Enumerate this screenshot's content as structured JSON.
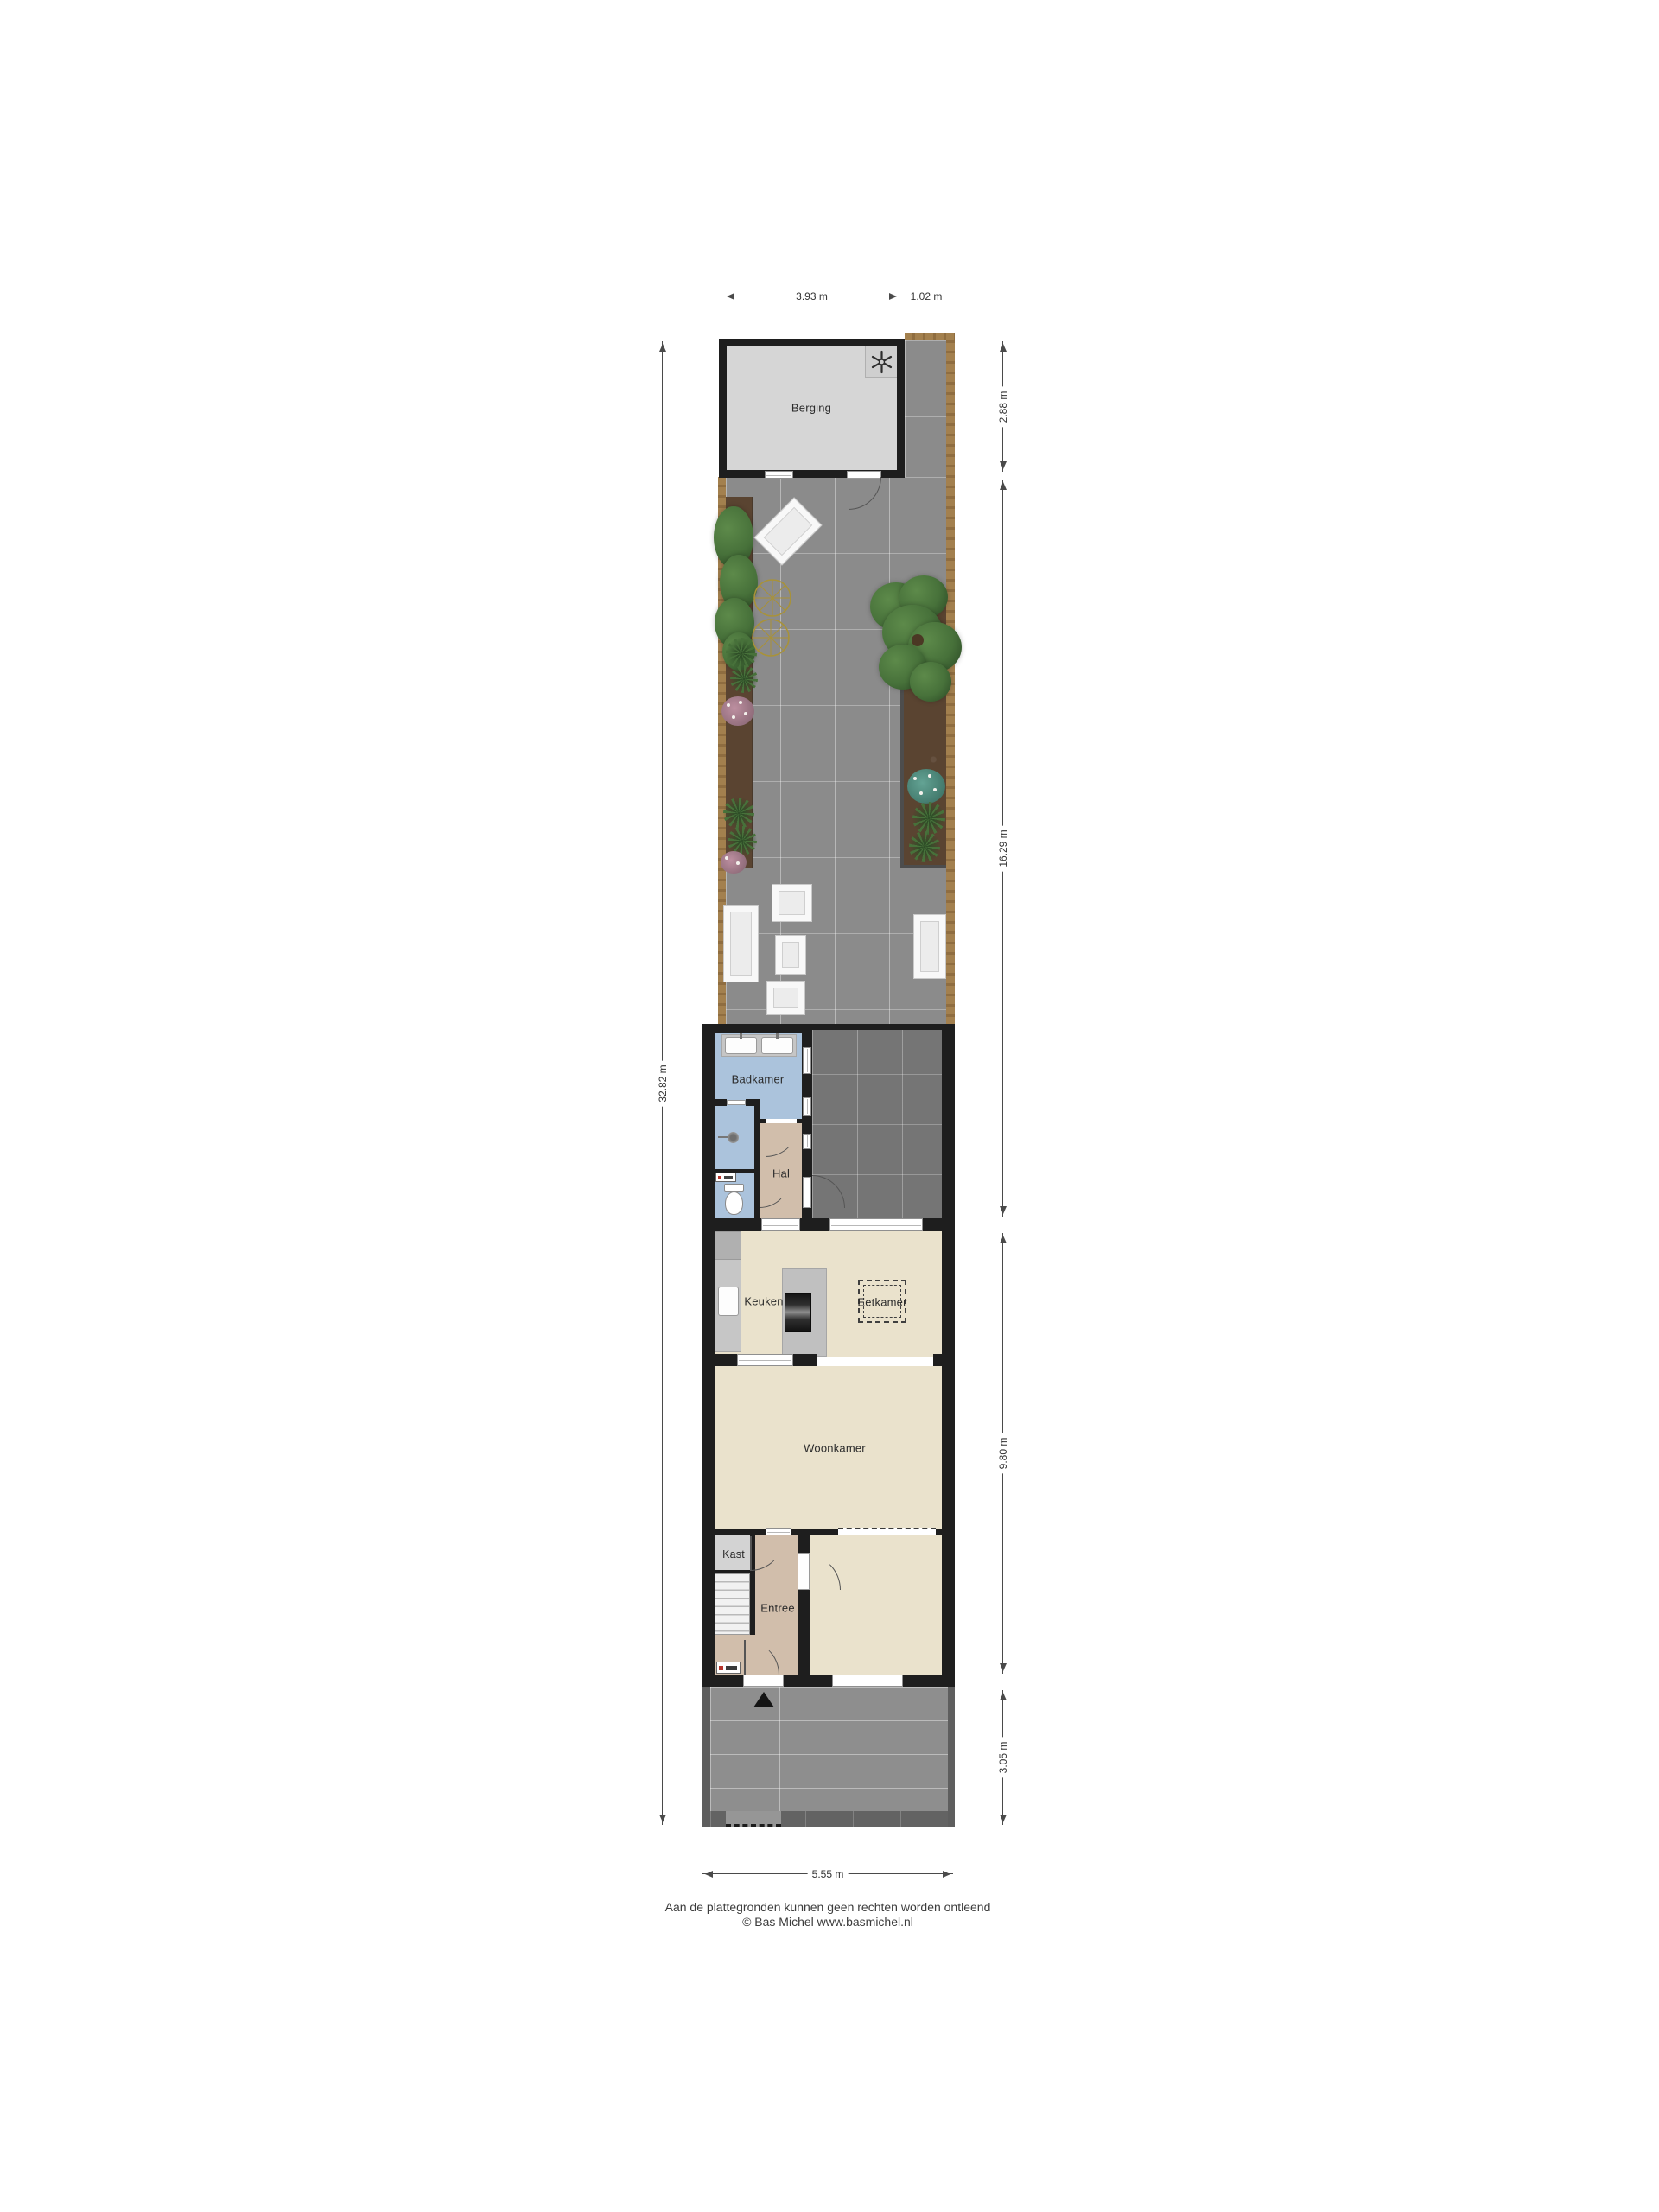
{
  "rooms": {
    "berging": "Berging",
    "badkamer": "Badkamer",
    "hal": "Hal",
    "keuken": "Keuken",
    "eetkamer": "Eetkamer",
    "woonkamer": "Woonkamer",
    "kast": "Kast",
    "entree": "Entree"
  },
  "dimensions": {
    "shed_width": "3.93 m",
    "path_width": "1.02 m",
    "shed_depth": "2.88 m",
    "garden_depth": "16.29 m",
    "house_depth": "9.80 m",
    "front_garden_depth": "3.05 m",
    "plot_depth": "32.82 m",
    "plot_width": "5.55 m"
  },
  "footer": {
    "disclaimer": "Aan de plattegronden kunnen geen rechten worden ontleend",
    "credit": "© Bas Michel www.basmichel.nl"
  },
  "icons": {
    "washing_machine": "washing-machine-icon",
    "shower": "shower-icon",
    "toilet": "toilet-icon",
    "sink": "sink-icon",
    "stove": "stove-icon",
    "entrance_marker": "entrance-arrow-icon",
    "bicycles": "bicycle-wheels-icon",
    "tree": "tree-icon"
  },
  "colors": {
    "wall": "#1e1e1e",
    "tileGarden": "#8b8b8b",
    "tileTerrace": "#757575",
    "tileFront": "#8e8e8e",
    "fence": "#a3804e",
    "soil": "#5a4431",
    "floorShed": "#d6d6d6",
    "floorBath": "#abc3dc",
    "floorHall": "#d1beab",
    "floorLiving": "#eae2cc",
    "floorKast": "#d3d3d3",
    "counter": "#c6c6c6",
    "leaf": "#47713a",
    "leafLight": "#5d8a4a",
    "leafDark": "#2f4f28",
    "teal": "#63a394",
    "pink": "#bd8fa0",
    "wheel": "#a8923a",
    "arc": "#555555",
    "dim": "#4a4a4a",
    "text": "#2b2b2b"
  }
}
